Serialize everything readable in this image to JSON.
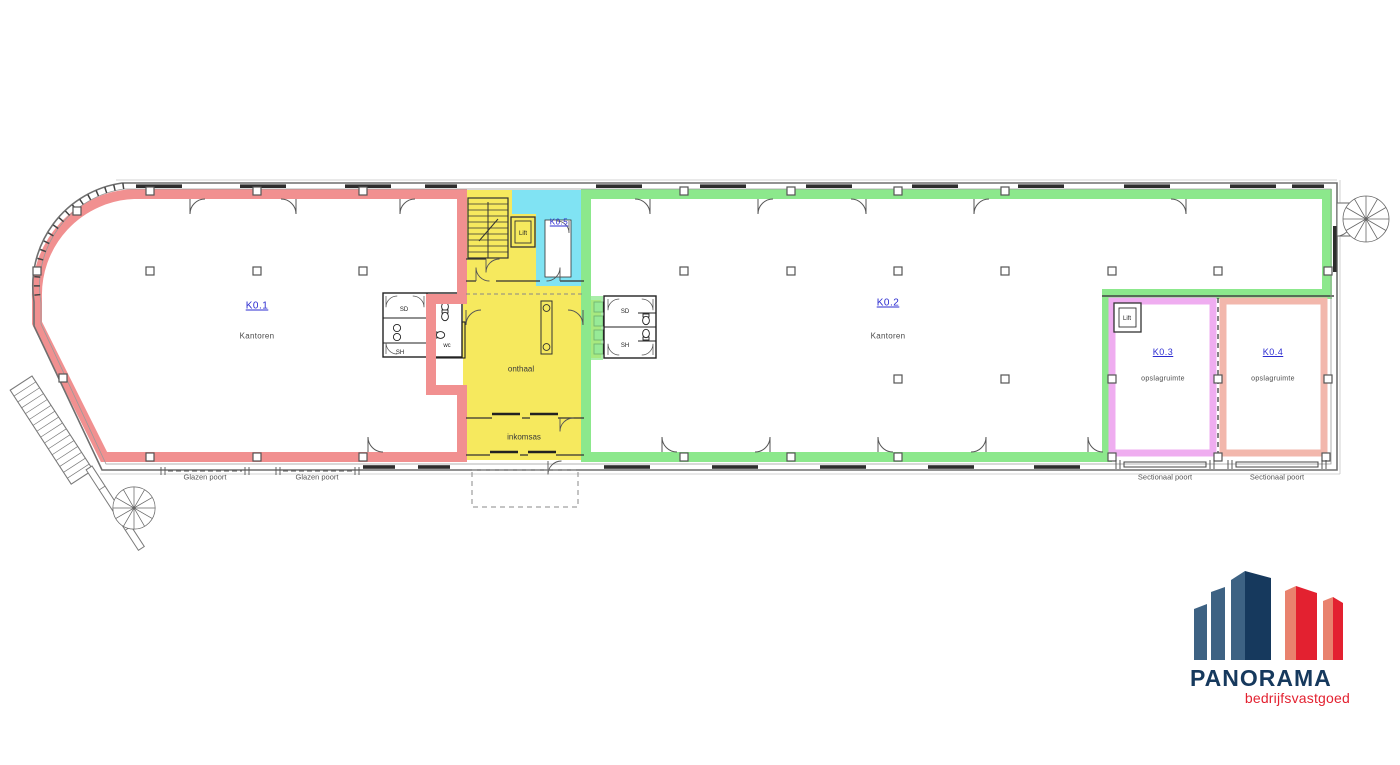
{
  "plan": {
    "label_color": "#2b2bd0",
    "zones": {
      "k01": {
        "code": "K0.1",
        "name": "Kantoren",
        "color": "#f19090"
      },
      "k02": {
        "code": "K0.2",
        "name": "Kantoren",
        "color": "#8ce88c"
      },
      "k03": {
        "code": "K0.3",
        "name": "opslagruimte",
        "color": "#efadf0"
      },
      "k04": {
        "code": "K0.4",
        "name": "opslagruimte",
        "color": "#f2b7ac"
      },
      "k05": {
        "code": "K0.5",
        "color": "#80e3f3"
      },
      "core": {
        "color": "#f6e95e"
      }
    },
    "rooms": {
      "onthaal": "onthaal",
      "inkomsas": "inkomsas",
      "wc": "wc",
      "lift": "Lift",
      "sd": "SD",
      "sh": "SH"
    },
    "doors": {
      "glazen": "Glazen poort",
      "sectionaal": "Sectionaal poort"
    }
  },
  "logo": {
    "name": "PANORAMA",
    "tagline": "bedrijfsvastgoed",
    "colors": {
      "navy": "#16395d",
      "steel": "#3d6283",
      "red": "#e32130",
      "salmon": "#e9826e"
    }
  }
}
